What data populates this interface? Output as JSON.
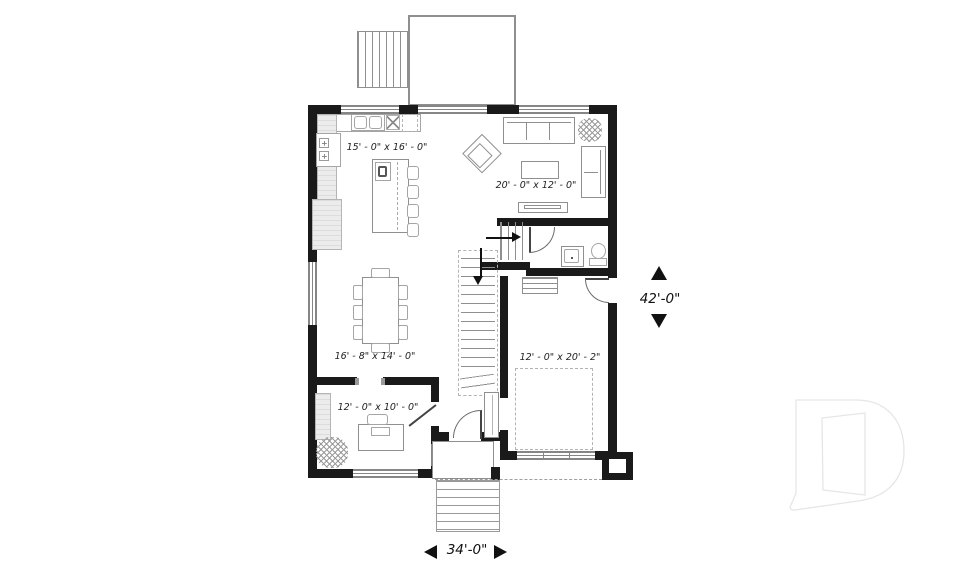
{
  "plan_title": "first-floor-plan",
  "rooms": [
    {
      "name": "kitchen",
      "dim": "15' - 0\" x 16' - 0\""
    },
    {
      "name": "living",
      "dim": "20' - 0\" x 12' - 0\""
    },
    {
      "name": "dining",
      "dim": "16' - 8\" x 14' - 0\""
    },
    {
      "name": "office",
      "dim": "12' - 0\" x 10' - 0\""
    },
    {
      "name": "garage",
      "dim": "12' - 0\" x 20' - 2\""
    }
  ],
  "overall": {
    "depth": "42'-0\"",
    "width": "34'-0\""
  },
  "watermark": {
    "letter": "D"
  },
  "colors": {
    "wall": "#1a1a1a",
    "lines": "#8f8f8f",
    "text": "#222222",
    "watermark": "#e6e6e6"
  }
}
